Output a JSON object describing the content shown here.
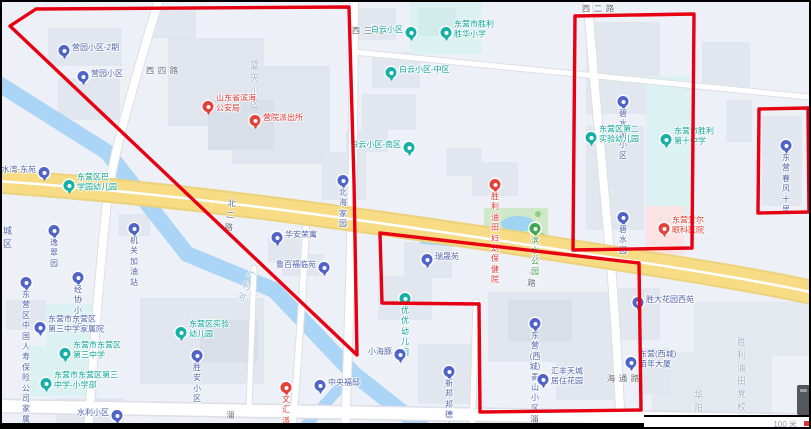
{
  "map_app": {
    "scale_label": "100 米",
    "annotation_color": "#e60012",
    "red_polygons": [
      {
        "name": "outlined-region-northwest",
        "points": [
          [
            34,
            7
          ],
          [
            347,
            5
          ],
          [
            352,
            180
          ],
          [
            355,
            353
          ],
          [
            8,
            24
          ]
        ]
      },
      {
        "name": "outlined-region-south-center",
        "points": [
          [
            378,
            231
          ],
          [
            637,
            261
          ],
          [
            639,
            408
          ],
          [
            478,
            410
          ],
          [
            477,
            302
          ],
          [
            380,
            301
          ]
        ]
      },
      {
        "name": "outlined-region-northeast",
        "points": [
          [
            573,
            14
          ],
          [
            692,
            12
          ],
          [
            690,
            246
          ],
          [
            571,
            248
          ]
        ]
      },
      {
        "name": "outlined-region-east-small",
        "points": [
          [
            757,
            107
          ],
          [
            806,
            106
          ],
          [
            807,
            210
          ],
          [
            756,
            211
          ]
        ]
      }
    ],
    "road_labels": [
      {
        "text": "北二路",
        "x": 224,
        "y": 195,
        "rotate": 7
      },
      {
        "text": "北二路",
        "x": 527,
        "y": 251,
        "rotate": 8
      },
      {
        "text": "淄博路",
        "x": 224,
        "y": 407,
        "rotate": 1
      },
      {
        "text": "淄博路",
        "x": 528,
        "y": 411,
        "rotate": 1
      },
      {
        "text": "西四路",
        "x": 142,
        "y": 64,
        "vertical": true
      },
      {
        "text": "西三路",
        "x": 348,
        "y": 24,
        "vertical": true
      },
      {
        "text": "西二路",
        "x": 578,
        "y": 2,
        "vertical": true
      },
      {
        "text": "海通路",
        "x": 603,
        "y": 372,
        "vertical": true
      },
      {
        "text": "广利河",
        "x": 240,
        "y": 266,
        "rotate": 24,
        "color": "#8fb3d9"
      }
    ],
    "area_labels": [
      {
        "text": "蓝天小区",
        "x": 248,
        "y": 56
      },
      {
        "text": "胜利油田党校",
        "x": 735,
        "y": 333
      },
      {
        "text": "华阳小区",
        "x": 692,
        "y": 386
      },
      {
        "text": "城\n区",
        "x": 1,
        "y": 222,
        "color": "#5265ad"
      }
    ],
    "pins": [
      {
        "name": "pin-yingyuan-xiaoqu-2qi",
        "c": "blue",
        "x": 62,
        "y": 54,
        "p": "right",
        "t": "营园小区-2期"
      },
      {
        "name": "pin-yingyuan-xiaoqu",
        "c": "blue",
        "x": 81,
        "y": 80,
        "p": "right",
        "t": "营园小区"
      },
      {
        "name": "pin-binhai-gonganju",
        "c": "red",
        "x": 206,
        "y": 110,
        "p": "right",
        "t": "山东省滨海\n公安局"
      },
      {
        "name": "pin-yingyuan-paichusuo",
        "c": "red",
        "x": 253,
        "y": 124,
        "p": "right",
        "t": "营院派出所"
      },
      {
        "name": "pin-baiyun-xiaoqu",
        "c": "teal",
        "x": 409,
        "y": 36,
        "p": "left",
        "t": "白云小区"
      },
      {
        "name": "pin-shenghua-xiaoxue",
        "c": "teal",
        "x": 444,
        "y": 36,
        "p": "right",
        "t": "东营市胜利\n胜华小学"
      },
      {
        "name": "pin-baiyun-zhongqu",
        "c": "teal",
        "x": 389,
        "y": 76,
        "p": "right",
        "t": "白云小区-中区"
      },
      {
        "name": "pin-baiyun-nanqu",
        "c": "teal",
        "x": 407,
        "y": 151,
        "p": "left",
        "t": "白云小区-南区"
      },
      {
        "name": "pin-bishuiyuan-xiaoqu",
        "c": "blue",
        "x": 621,
        "y": 105,
        "p": "below",
        "t": "碧水苑小区"
      },
      {
        "name": "pin-dier-shiyan-youeryuan",
        "c": "teal",
        "x": 589,
        "y": 141,
        "p": "right",
        "t": "东营区第二\n实验幼儿园"
      },
      {
        "name": "pin-shengli-dishi-zhongxue",
        "c": "teal",
        "x": 664,
        "y": 143,
        "p": "right",
        "t": "东营市胜利\n第十中学"
      },
      {
        "name": "pin-chunfeng-shili",
        "c": "blue",
        "x": 784,
        "y": 149,
        "p": "below",
        "t": "东营春风十里"
      },
      {
        "name": "pin-bishuiyuan",
        "c": "blue",
        "x": 621,
        "y": 221,
        "p": "below",
        "t": "碧水园"
      },
      {
        "name": "pin-aier-yanke",
        "c": "red",
        "x": 662,
        "y": 232,
        "p": "right",
        "t": "东营爱尔\n眼科医院"
      },
      {
        "name": "pin-binshui-gongyuan",
        "c": "green",
        "x": 533,
        "y": 232,
        "p": "below",
        "t": "滨水公园"
      },
      {
        "name": "pin-fuyou-baojianyuan",
        "c": "red",
        "x": 493,
        "y": 188,
        "p": "below",
        "t": "胜利油田\n妇幼保健院"
      },
      {
        "name": "pin-qianshuiwan-dongyuan",
        "c": "blue",
        "x": 42,
        "y": 176,
        "p": "left",
        "t": "浅水湾-东苑"
      },
      {
        "name": "pin-baxueyuan-youeryuan",
        "c": "teal",
        "x": 67,
        "y": 189,
        "p": "right",
        "t": "东营区巴\n学园幼儿园"
      },
      {
        "name": "pin-yicuiyuan",
        "c": "blue",
        "x": 52,
        "y": 234,
        "p": "below",
        "t": "逸翠园"
      },
      {
        "name": "pin-jiguan-jiayouzhan",
        "c": "blue",
        "x": 132,
        "y": 232,
        "p": "below",
        "t": "机关加油站"
      },
      {
        "name": "pin-beihai-jiayuan",
        "c": "blue",
        "x": 341,
        "y": 184,
        "p": "below",
        "t": "北海家园"
      },
      {
        "name": "pin-huaan-rongyu",
        "c": "blue",
        "x": 275,
        "y": 241,
        "p": "right",
        "t": "华安荣寓"
      },
      {
        "name": "pin-lubai-fulinyuan",
        "c": "blue",
        "x": 322,
        "y": 271,
        "p": "left",
        "t": "鲁百福临苑"
      },
      {
        "name": "pin-ruishengyuan",
        "c": "blue",
        "x": 425,
        "y": 263,
        "p": "right",
        "t": "瑞晟苑"
      },
      {
        "name": "pin-youyou-youeryuan",
        "c": "teal",
        "x": 403,
        "y": 302,
        "p": "below",
        "t": "优优幼儿园"
      },
      {
        "name": "pin-xiaohaitun",
        "c": "blue",
        "x": 398,
        "y": 358,
        "p": "left",
        "t": "小海豚"
      },
      {
        "name": "pin-zhongyang-fudi",
        "c": "blue",
        "x": 318,
        "y": 389,
        "p": "right",
        "t": "中央福邸"
      },
      {
        "name": "pin-wenhui-paichusuo",
        "c": "red",
        "x": 284,
        "y": 391,
        "p": "below",
        "t": "文汇派出所"
      },
      {
        "name": "pin-xinbang-bangde",
        "c": "blue",
        "x": 447,
        "y": 375,
        "p": "below",
        "t": "新邦邦德小镇"
      },
      {
        "name": "pin-qingshan-xiaoqu",
        "c": "blue",
        "x": 533,
        "y": 327,
        "p": "below",
        "t": "东营(西城)\n青山小区"
      },
      {
        "name": "pin-huifeng-tiancheng",
        "c": "blue",
        "x": 541,
        "y": 383,
        "p": "right",
        "t": "汇丰天城\n居住花园"
      },
      {
        "name": "pin-shengda-huayuan-xiyuan",
        "c": "blue",
        "x": 636,
        "y": 306,
        "p": "right",
        "t": "胜大花园西苑"
      },
      {
        "name": "pin-bainian-dasha",
        "c": "blue",
        "x": 629,
        "y": 366,
        "p": "right",
        "t": "东营(西城)\n佰年大厦"
      },
      {
        "name": "pin-renshou-jiashuyuan",
        "c": "blue",
        "x": 24,
        "y": 286,
        "p": "below",
        "t": "东营区中国人寿\n保险公司家属院"
      },
      {
        "name": "pin-jingxie-xiaoqu",
        "c": "blue",
        "x": 76,
        "y": 281,
        "p": "below",
        "t": "经协小区"
      },
      {
        "name": "pin-sanzhong-jiashuyuan",
        "c": "blue",
        "x": 38,
        "y": 331,
        "p": "right",
        "t": "东营市东营区\n第三中学家属院"
      },
      {
        "name": "pin-sanzhong",
        "c": "teal",
        "x": 63,
        "y": 357,
        "p": "right",
        "t": "东营市东营区\n第三中学"
      },
      {
        "name": "pin-sanzhong-xiaoxuebu",
        "c": "teal",
        "x": 44,
        "y": 387,
        "p": "right",
        "t": "东营市东营区第三\n中学-小学部"
      },
      {
        "name": "pin-shiyan-youeryuan",
        "c": "teal",
        "x": 179,
        "y": 336,
        "p": "right",
        "t": "东营区实验\n幼儿园"
      },
      {
        "name": "pin-shengan-xiaoqu",
        "c": "blue",
        "x": 195,
        "y": 359,
        "p": "below",
        "t": "胜安小区"
      },
      {
        "name": "pin-shuili-xiaoqu",
        "c": "blue",
        "x": 115,
        "y": 419,
        "p": "left",
        "t": "水利小区"
      }
    ]
  }
}
